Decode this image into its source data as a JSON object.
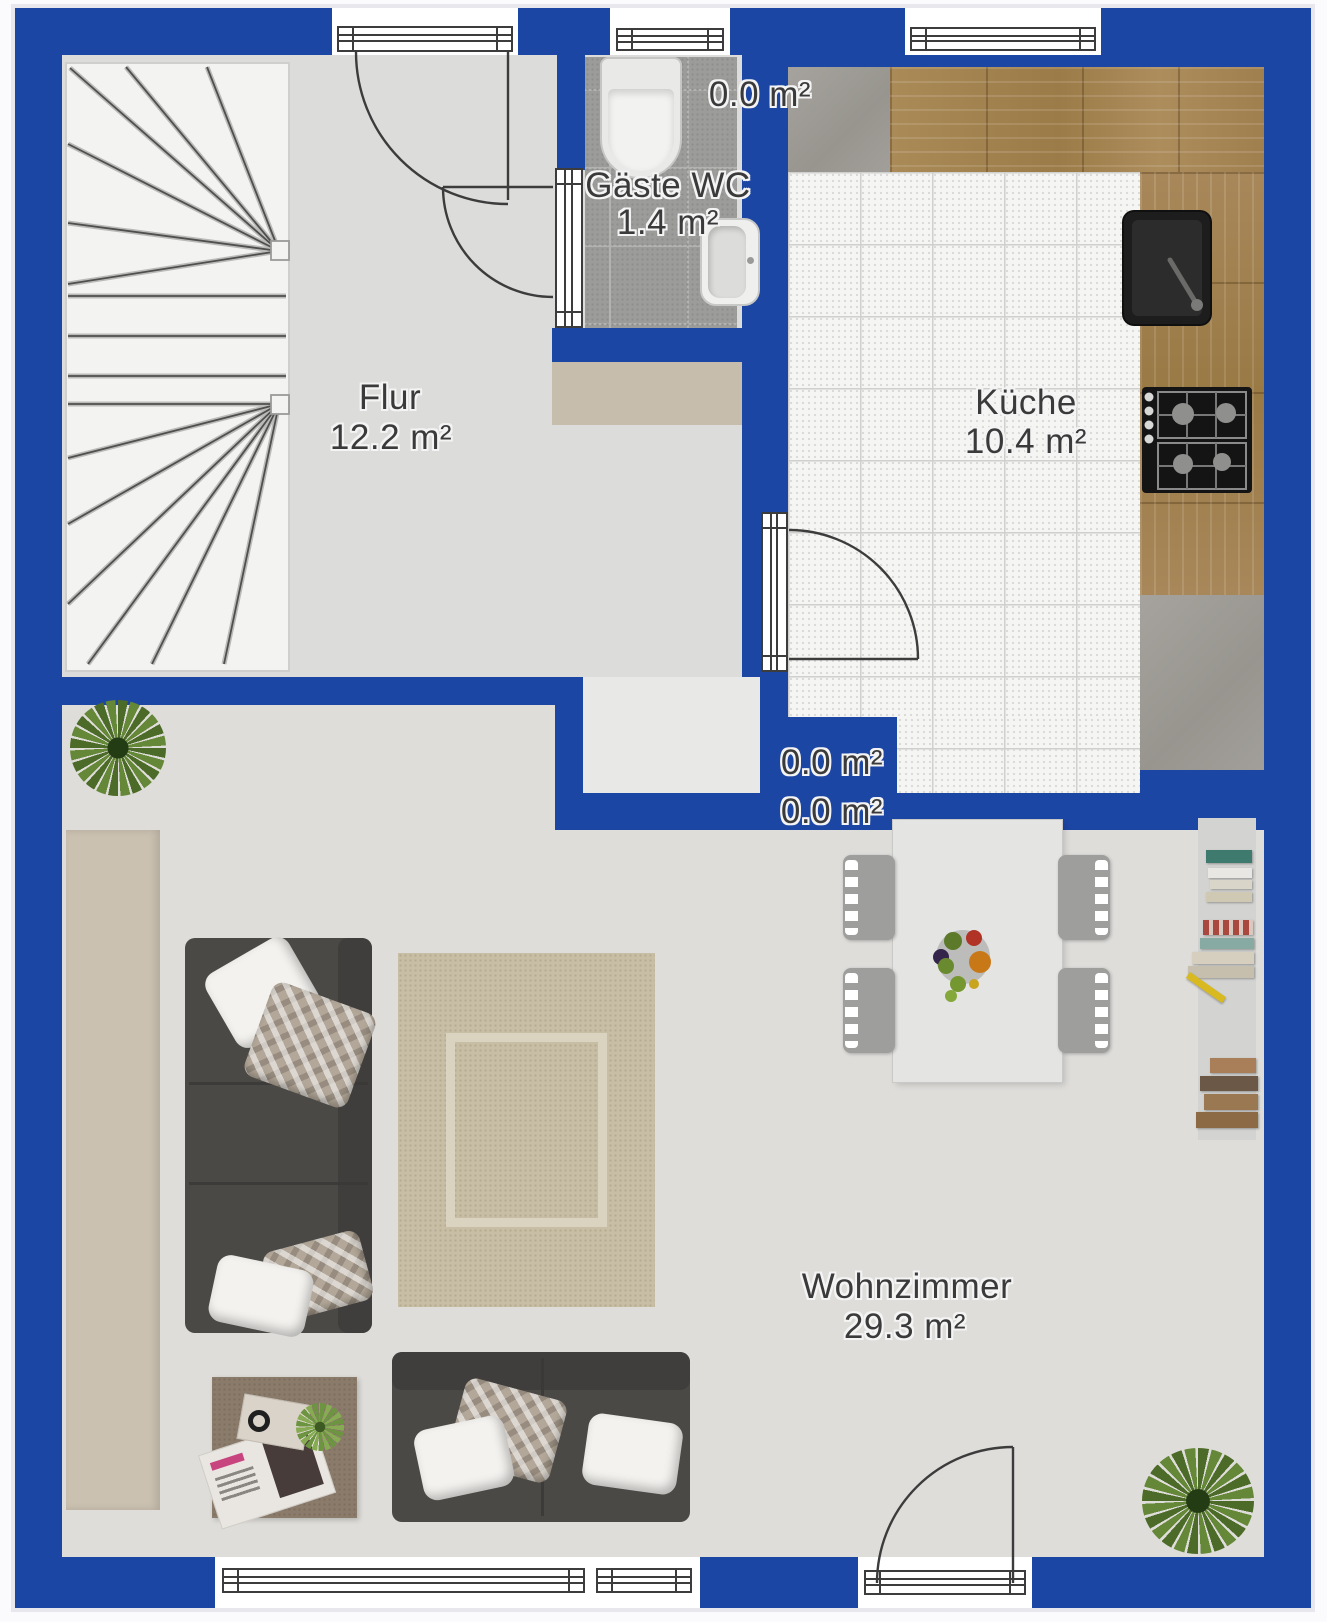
{
  "rooms": {
    "flur": {
      "name": "Flur",
      "area": "12.2 m²"
    },
    "gaeste_wc": {
      "name": "Gäste WC",
      "area": "1.4 m²"
    },
    "kueche": {
      "name": "Küche",
      "area": "10.4 m²"
    },
    "wohnzimmer": {
      "name": "Wohnzimmer",
      "area": "29.3 m²"
    }
  },
  "annotations": {
    "zero_top": "0.0 m²",
    "zero_mid_upper": "0.0 m²",
    "zero_mid_lower": "0.0 m²"
  },
  "colors": {
    "wall_blue": "#1c46a4",
    "floor_gray": "#dcdcda",
    "wc_tile_gray": "#9c9c9a",
    "kitchen_tile_white": "#f5f5f3",
    "counter_wood_brown": "#a5854f",
    "counter_concrete_gray": "#a09d99",
    "accent_beige": "#c7bdac",
    "sofa_charcoal": "#4b4946",
    "label_text": "#3a3a3a"
  }
}
